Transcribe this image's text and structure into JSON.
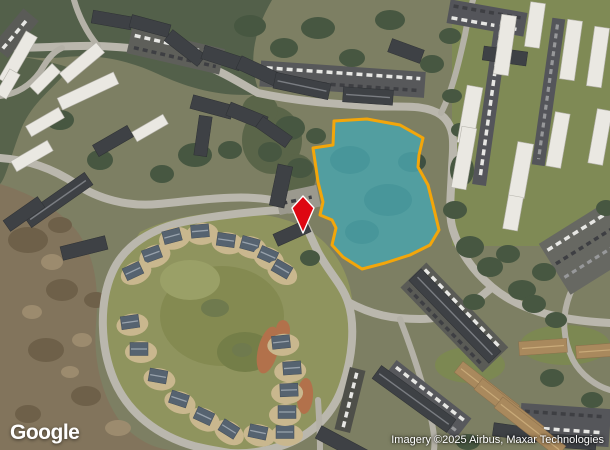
{
  "map": {
    "view_type": "satellite",
    "logo_text": "Google",
    "attribution_text": "Imagery ©2025 Airbus, Maxar Technologies",
    "parcel": {
      "points": "334,121 367,119 400,125 423,138 419,155 418,167 428,185 433,205 439,230 430,245 410,255 385,263 362,269 343,257 332,245 336,228 332,220 320,215 323,202 318,182 316,168 313,148 333,145",
      "fill": "#4aa4ab",
      "fill_opacity": "0.84",
      "stroke": "#f3a60a",
      "stroke_width": "3"
    },
    "marker": {
      "points": "303,196 314,208 303,233 292,208",
      "fill": "#de0712",
      "stroke": "#ffffff",
      "stroke_width": "1.4"
    }
  }
}
